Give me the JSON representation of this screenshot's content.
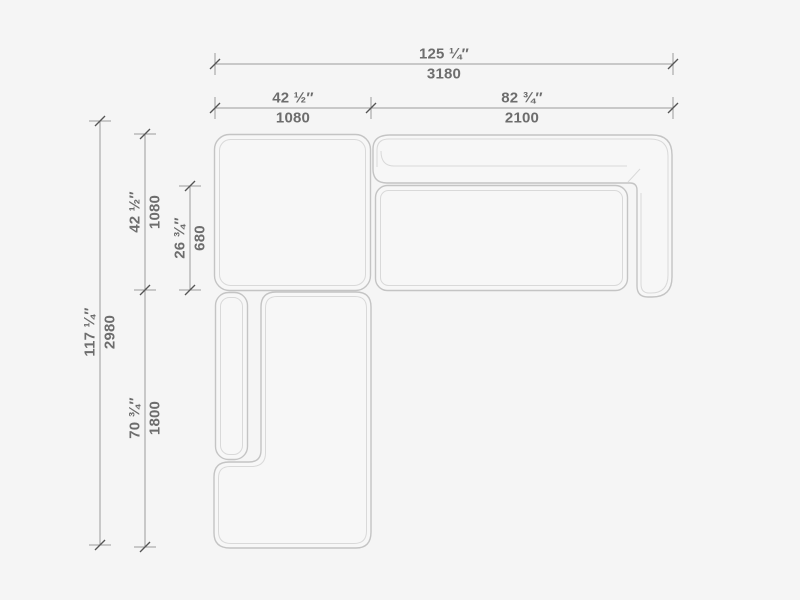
{
  "drawing": {
    "units_primary": "inches",
    "units_secondary": "mm",
    "colors": {
      "background": "#f5f5f5",
      "module_fill": "#f7f7f7",
      "outline": "#c4c4c4",
      "outline_inner": "#d9d9d9",
      "dimension_line": "#9a9a9a",
      "tick_slash": "#555555",
      "label_text": "#6d6d6d"
    },
    "dimensions": {
      "overall_width": {
        "inches": "125 ¼″",
        "mm": "3180"
      },
      "left_section_width": {
        "inches": "42 ½″",
        "mm": "1080"
      },
      "right_section_width": {
        "inches": "82 ¾″",
        "mm": "2100"
      },
      "overall_depth": {
        "inches": "117 ¼″",
        "mm": "2980"
      },
      "left_section_depth": {
        "inches": "42 ½″",
        "mm": "1080"
      },
      "seat_depth": {
        "inches": "26 ¾″",
        "mm": "680"
      },
      "chaise_length": {
        "inches": "70 ¾″",
        "mm": "1800"
      }
    }
  }
}
